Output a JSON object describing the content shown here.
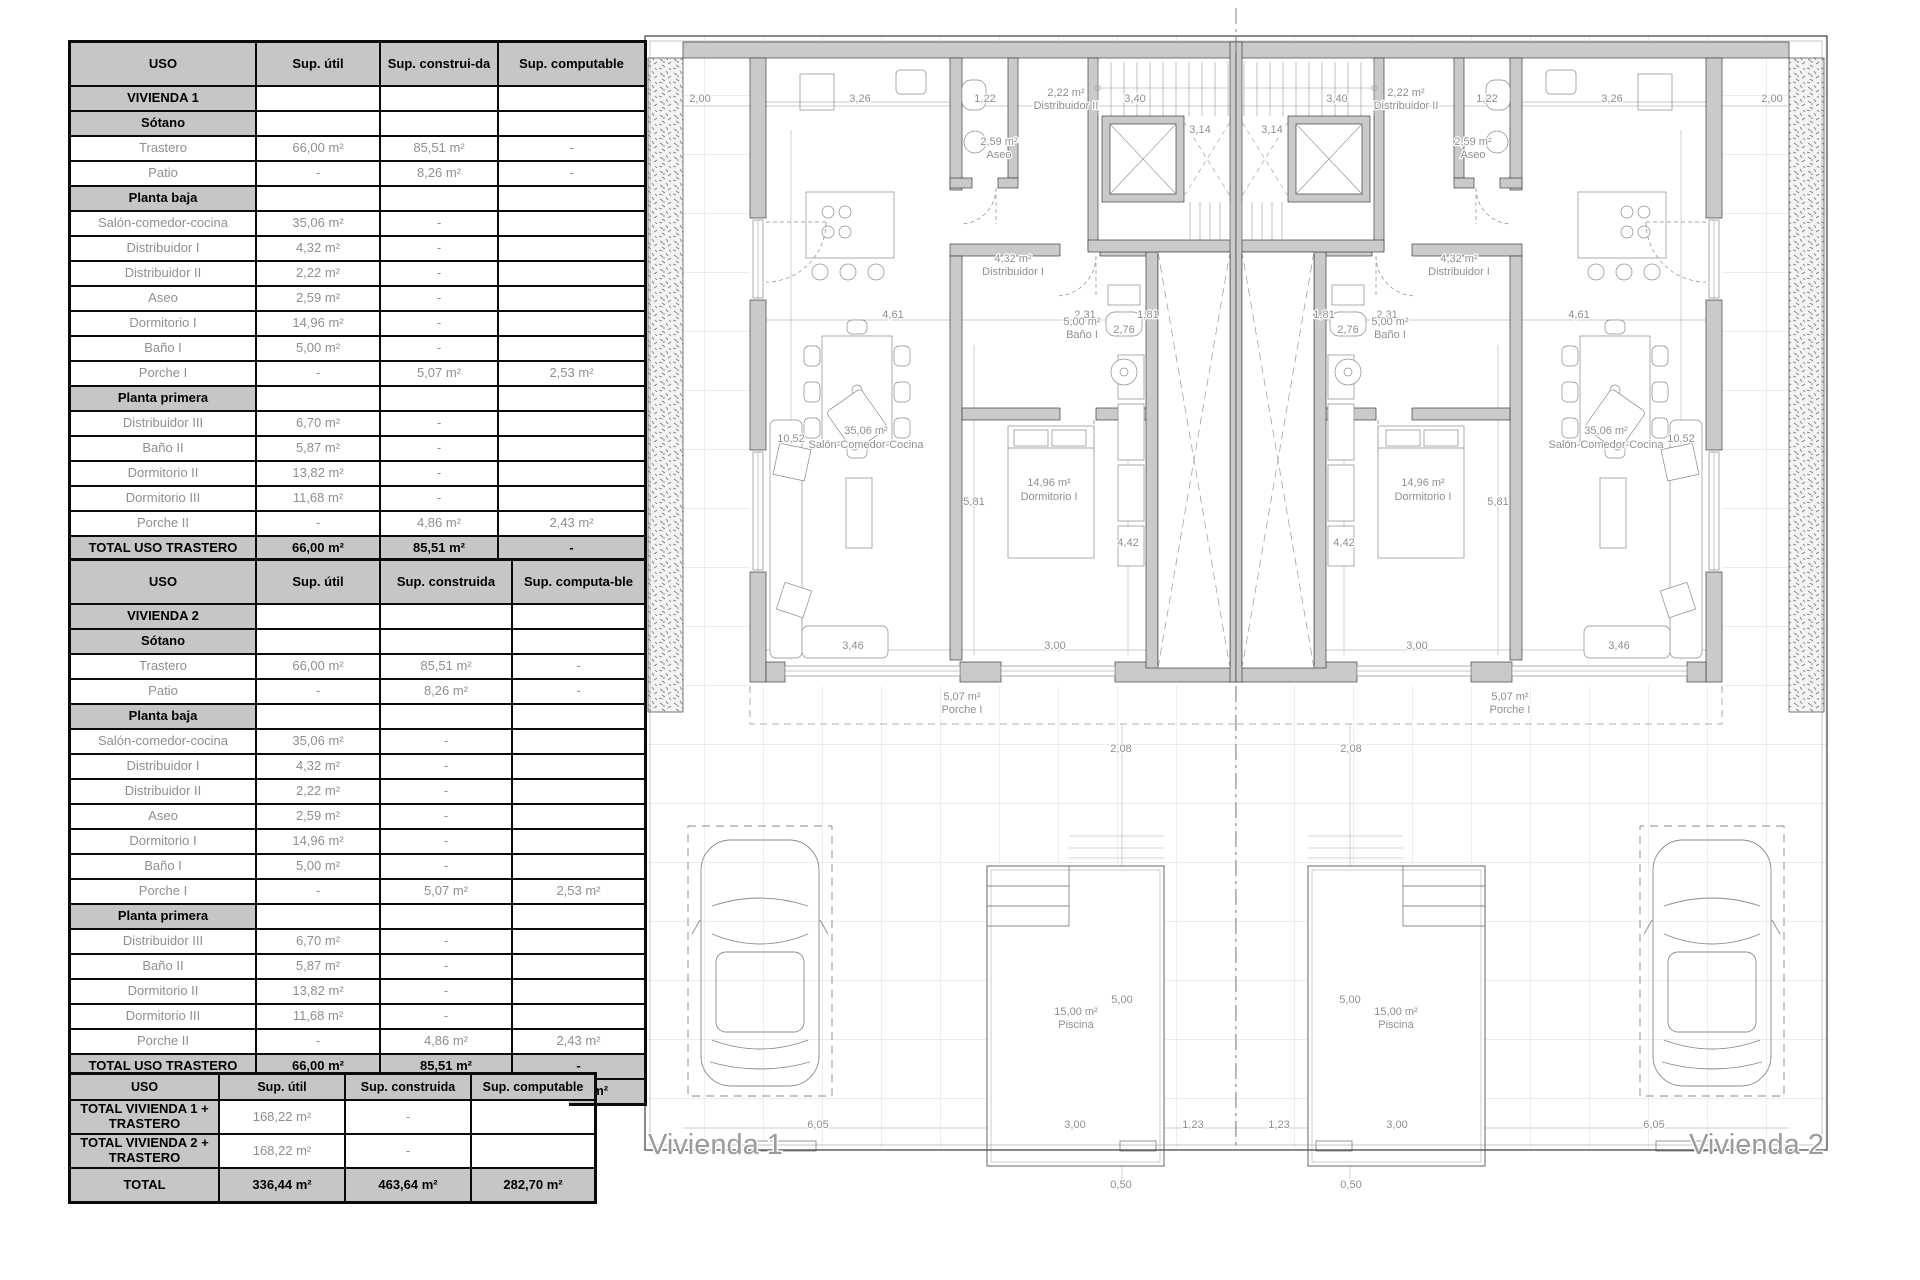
{
  "tables": {
    "table1": {
      "headers": [
        "USO",
        "Sup. útil",
        "Sup. construi-da",
        "Sup. computable"
      ],
      "rows": [
        {
          "type": "section",
          "cells": [
            "VIVIENDA 1",
            "",
            "",
            ""
          ]
        },
        {
          "type": "section",
          "cells": [
            "Sótano",
            "",
            "",
            ""
          ]
        },
        {
          "type": "data",
          "cells": [
            "Trastero",
            "66,00 m²",
            "85,51 m²",
            "-"
          ]
        },
        {
          "type": "data",
          "cells": [
            "Patio",
            "-",
            "8,26 m²",
            "-"
          ]
        },
        {
          "type": "section",
          "cells": [
            "Planta baja",
            "",
            "",
            ""
          ]
        },
        {
          "type": "data",
          "cells": [
            "Salón-comedor-cocina",
            "35,06 m²",
            "-",
            ""
          ]
        },
        {
          "type": "data",
          "cells": [
            "Distribuidor I",
            "4,32 m²",
            "-",
            ""
          ]
        },
        {
          "type": "data",
          "cells": [
            "Distribuidor II",
            "2,22 m²",
            "-",
            ""
          ]
        },
        {
          "type": "data",
          "cells": [
            "Aseo",
            "2,59 m²",
            "-",
            ""
          ]
        },
        {
          "type": "data",
          "cells": [
            "Dormitorio I",
            "14,96 m²",
            "-",
            ""
          ]
        },
        {
          "type": "data",
          "cells": [
            "Baño I",
            "5,00 m²",
            "-",
            ""
          ]
        },
        {
          "type": "data",
          "cells": [
            "Porche I",
            "-",
            "5,07 m²",
            "2,53 m²"
          ]
        },
        {
          "type": "section",
          "cells": [
            "Planta primera",
            "",
            "",
            ""
          ]
        },
        {
          "type": "data",
          "cells": [
            "Distribuidor III",
            "6,70 m²",
            "-",
            ""
          ]
        },
        {
          "type": "data",
          "cells": [
            "Baño II",
            "5,87 m²",
            "-",
            ""
          ]
        },
        {
          "type": "data",
          "cells": [
            "Dormitorio II",
            "13,82 m²",
            "-",
            ""
          ]
        },
        {
          "type": "data",
          "cells": [
            "Dormitorio III",
            "11,68 m²",
            "-",
            ""
          ]
        },
        {
          "type": "data",
          "cells": [
            "Porche II",
            "-",
            "4,86 m²",
            "2,43 m²"
          ]
        },
        {
          "type": "total",
          "cells": [
            "TOTAL USO TRASTERO",
            "66,00 m²",
            "85,51 m²",
            "-"
          ]
        },
        {
          "type": "total",
          "cells": [
            "TOTAL USO VIVIENDA",
            "102,22 m²",
            "146,31 m²",
            "141,35 m²"
          ]
        }
      ]
    },
    "table2": {
      "headers": [
        "USO",
        "Sup. útil",
        "Sup. construida",
        "Sup. computa-ble"
      ],
      "rows": [
        {
          "type": "section",
          "cells": [
            "VIVIENDA 2",
            "",
            "",
            ""
          ]
        },
        {
          "type": "section",
          "cells": [
            "Sótano",
            "",
            "",
            ""
          ]
        },
        {
          "type": "data",
          "cells": [
            "Trastero",
            "66,00 m²",
            "85,51 m²",
            "-"
          ]
        },
        {
          "type": "data",
          "cells": [
            "Patio",
            "-",
            "8,26 m²",
            "-"
          ]
        },
        {
          "type": "section",
          "cells": [
            "Planta baja",
            "",
            "",
            ""
          ]
        },
        {
          "type": "data",
          "cells": [
            "Salón-comedor-cocina",
            "35,06 m²",
            "-",
            ""
          ]
        },
        {
          "type": "data",
          "cells": [
            "Distribuidor I",
            "4,32 m²",
            "-",
            ""
          ]
        },
        {
          "type": "data",
          "cells": [
            "Distribuidor II",
            "2,22 m²",
            "-",
            ""
          ]
        },
        {
          "type": "data",
          "cells": [
            "Aseo",
            "2,59 m²",
            "-",
            ""
          ]
        },
        {
          "type": "data",
          "cells": [
            "Dormitorio I",
            "14,96 m²",
            "-",
            ""
          ]
        },
        {
          "type": "data",
          "cells": [
            "Baño I",
            "5,00 m²",
            "-",
            ""
          ]
        },
        {
          "type": "data",
          "cells": [
            "Porche I",
            "-",
            "5,07 m²",
            "2,53 m²"
          ]
        },
        {
          "type": "section",
          "cells": [
            "Planta primera",
            "",
            "",
            ""
          ]
        },
        {
          "type": "data",
          "cells": [
            "Distribuidor III",
            "6,70 m²",
            "-",
            ""
          ]
        },
        {
          "type": "data",
          "cells": [
            "Baño II",
            "5,87 m²",
            "-",
            ""
          ]
        },
        {
          "type": "data",
          "cells": [
            "Dormitorio II",
            "13,82 m²",
            "-",
            ""
          ]
        },
        {
          "type": "data",
          "cells": [
            "Dormitorio III",
            "11,68 m²",
            "-",
            ""
          ]
        },
        {
          "type": "data",
          "cells": [
            "Porche II",
            "-",
            "4,86 m²",
            "2,43 m²"
          ]
        },
        {
          "type": "total",
          "cells": [
            "TOTAL USO TRASTERO",
            "66,00 m²",
            "85,51 m²",
            "-"
          ]
        },
        {
          "type": "total",
          "cells": [
            "TOTAL USO VIVIENDA",
            "102,22 m²",
            "146,31 m²",
            "141,35 m²"
          ]
        }
      ]
    },
    "table3": {
      "headers": [
        "USO",
        "Sup. útil",
        "Sup. construida",
        "Sup. computable"
      ],
      "rows": [
        {
          "type": "section",
          "cells": [
            "TOTAL VIVIENDA 1 + TRASTERO",
            "168,22 m²",
            "-",
            ""
          ]
        },
        {
          "type": "section",
          "cells": [
            "TOTAL VIVIENDA 2 + TRASTERO",
            "168,22 m²",
            "-",
            ""
          ]
        },
        {
          "type": "total",
          "cells": [
            "TOTAL",
            "336,44 m²",
            "463,64 m²",
            "282,70 m²"
          ]
        }
      ]
    }
  },
  "plan": {
    "vivienda1": "Vivienda 1",
    "vivienda2": "Vivienda 2",
    "rooms": {
      "distribuidor2": {
        "area": "2,22 m²",
        "name": "Distribuidor II"
      },
      "aseo": {
        "area": "2,59 m²",
        "name": "Aseo"
      },
      "distribuidor1": {
        "area": "4,32 m²",
        "name": "Distribuidor I"
      },
      "bano1": {
        "area": "5,00 m²",
        "name": "Baño I"
      },
      "dormitorio1": {
        "area": "14,96 m²",
        "name": "Dormitorio I"
      },
      "salon": {
        "area": "35,06 m²",
        "name": "Salón-Comedor-Cocina"
      },
      "porche1": {
        "area": "5,07 m²",
        "name": "Porche I"
      },
      "piscina": {
        "area": "15,00 m²",
        "name": "Piscina"
      }
    },
    "dims": {
      "d2_00": "2,00",
      "d3_26": "3,26",
      "d1_22": "1,22",
      "d3_40": "3,40",
      "d3_14": "3,14",
      "d4_61": "4,61",
      "d2_31": "2,31",
      "d1_81": "1,81",
      "d10_52": "10,52",
      "d5_81": "5,81",
      "d4_42": "4,42",
      "d2_76": "2,76",
      "d3_46": "3,46",
      "d3_00": "3,00",
      "d2_08": "2,08",
      "d5_00": "5,00",
      "d1_23": "1,23",
      "d6_05": "6,05",
      "d0_50": "0,50"
    }
  }
}
